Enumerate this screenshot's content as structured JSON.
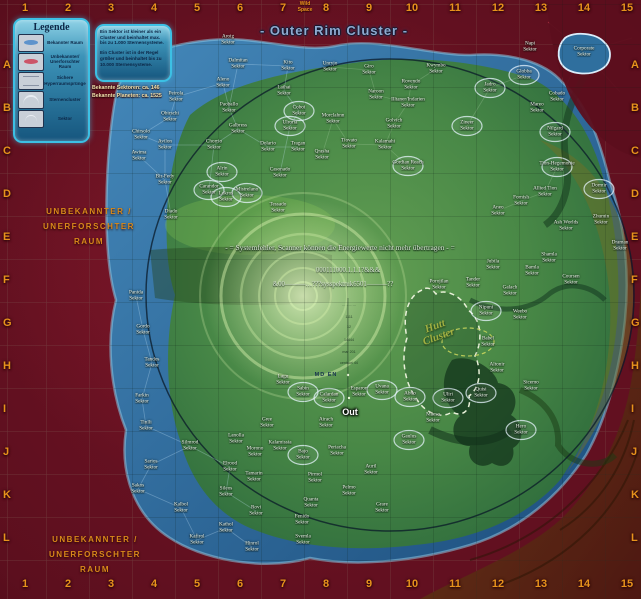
{
  "title": "- Outer Rim Cluster -",
  "wild": {
    "line1": "Wild",
    "line2": "Space"
  },
  "legend": {
    "title": "Legende",
    "items": [
      {
        "label": "Bekannter Raum",
        "icon": "blob-blue"
      },
      {
        "label": "Unbekannter/ Unerforschter Raum",
        "icon": "blob-red"
      },
      {
        "label": "Sichere Hyperraumsprünge",
        "icon": "lines"
      },
      {
        "label": "Sternencluster",
        "icon": "arc"
      },
      {
        "label": "Sektor",
        "icon": "arc2"
      }
    ]
  },
  "info_box": {
    "p1": "Ein Sektor ist kleiner als ein Cluster und beinhaltet max. bis zu 1.000 Sternensysteme.",
    "p2": "Ein Cluster ist in der Regel größer und beinhaltet bis zu 10.000 Sternensysteme."
  },
  "stats": {
    "sectors": "Bekannte Sektoren: ca. 146",
    "planets": "Bekannte Planeten: ca. 1525"
  },
  "unknown_label": {
    "line1": "UNBEKANNTER / UNERFORSCHTER",
    "line2": "RAUM"
  },
  "grid": {
    "columns": [
      "1",
      "2",
      "3",
      "4",
      "5",
      "6",
      "7",
      "8",
      "9",
      "10",
      "11",
      "12",
      "13",
      "14",
      "15"
    ],
    "rows": [
      "A",
      "B",
      "C",
      "D",
      "E",
      "F",
      "G",
      "H",
      "I",
      "J",
      "K",
      "L"
    ]
  },
  "scanner": {
    "error_line": "- = Systemfehler, Scanner können die Energiewerte nicht mehr übertragen - =",
    "code_line1": "000111000.1.1.1?&&&",
    "code_line2": "&00———…???sysspektruk6501———??",
    "md_en": "MD EN",
    "out": "Out",
    "ticks": [
      "…………",
      "1111",
      "12",
      "14444",
      "mar 201",
      "centauri 44"
    ]
  },
  "hutt_cluster": {
    "line1": "Hutt",
    "line2": "Cluster"
  },
  "sector_suffix": "Sektor",
  "sectors": [
    {
      "n": "Aroig",
      "x": 228,
      "y": 40,
      "o": 0
    },
    {
      "n": "Dalmitan",
      "x": 238,
      "y": 64,
      "o": 0
    },
    {
      "n": "Kito",
      "x": 288,
      "y": 66,
      "o": 0
    },
    {
      "n": "Aleno",
      "x": 223,
      "y": 83,
      "o": 0
    },
    {
      "n": "Laihai",
      "x": 284,
      "y": 91,
      "o": 0
    },
    {
      "n": "Peirola",
      "x": 176,
      "y": 97,
      "o": 0
    },
    {
      "n": "Paoballo",
      "x": 229,
      "y": 108,
      "o": 0
    },
    {
      "n": "Obirschi",
      "x": 170,
      "y": 117,
      "o": 0
    },
    {
      "n": "Coboi",
      "x": 299,
      "y": 111,
      "o": 1
    },
    {
      "n": "Ulroria",
      "x": 290,
      "y": 126,
      "o": 1
    },
    {
      "n": "Galbress",
      "x": 238,
      "y": 129,
      "o": 0
    },
    {
      "n": "Chirsolo",
      "x": 141,
      "y": 135,
      "o": 0
    },
    {
      "n": "Avilon",
      "x": 165,
      "y": 145,
      "o": 0
    },
    {
      "n": "Chorrio",
      "x": 214,
      "y": 145,
      "o": 0
    },
    {
      "n": "Dolario",
      "x": 268,
      "y": 147,
      "o": 0
    },
    {
      "n": "Tragan",
      "x": 298,
      "y": 147,
      "o": 0
    },
    {
      "n": "Awima",
      "x": 139,
      "y": 156,
      "o": 0
    },
    {
      "n": "Bir-Fedy",
      "x": 165,
      "y": 180,
      "o": 0
    },
    {
      "n": "Alrin",
      "x": 222,
      "y": 172,
      "o": 1
    },
    {
      "n": "Carandor",
      "x": 209,
      "y": 190,
      "o": 1
    },
    {
      "n": "Lekros",
      "x": 226,
      "y": 197,
      "o": 1
    },
    {
      "n": "Mistrelano",
      "x": 247,
      "y": 193,
      "o": 1
    },
    {
      "n": "Casonado",
      "x": 280,
      "y": 173,
      "o": 0
    },
    {
      "n": "Tessado",
      "x": 278,
      "y": 208,
      "o": 0
    },
    {
      "n": "Diado",
      "x": 171,
      "y": 215,
      "o": 0
    },
    {
      "n": "Panida",
      "x": 136,
      "y": 296,
      "o": 0
    },
    {
      "n": "Gordo",
      "x": 143,
      "y": 330,
      "o": 0
    },
    {
      "n": "Tandos",
      "x": 152,
      "y": 363,
      "o": 0
    },
    {
      "n": "Farkin",
      "x": 142,
      "y": 399,
      "o": 0
    },
    {
      "n": "Tinlli",
      "x": 146,
      "y": 426,
      "o": 0
    },
    {
      "n": "Sarios",
      "x": 151,
      "y": 465,
      "o": 0
    },
    {
      "n": "Sakos",
      "x": 138,
      "y": 489,
      "o": 0
    },
    {
      "n": "Kalbol",
      "x": 181,
      "y": 508,
      "o": 0
    },
    {
      "n": "Kafirol",
      "x": 197,
      "y": 540,
      "o": 0
    },
    {
      "n": "Hinrol",
      "x": 252,
      "y": 547,
      "o": 0
    },
    {
      "n": "Unryjo",
      "x": 330,
      "y": 67,
      "o": 0
    },
    {
      "n": "Giro",
      "x": 369,
      "y": 70,
      "o": 0
    },
    {
      "n": "Kwymbo",
      "x": 436,
      "y": 69,
      "o": 0
    },
    {
      "n": "Rovendo",
      "x": 411,
      "y": 85,
      "o": 0
    },
    {
      "n": "Naroon",
      "x": 376,
      "y": 95,
      "o": 0
    },
    {
      "n": "Illtaner/Indarien",
      "x": 408,
      "y": 103,
      "o": 0
    },
    {
      "n": "Morclahnn",
      "x": 333,
      "y": 119,
      "o": 0
    },
    {
      "n": "Golvich",
      "x": 394,
      "y": 124,
      "o": 0
    },
    {
      "n": "Zineer",
      "x": 467,
      "y": 126,
      "o": 1
    },
    {
      "n": "Tiovato",
      "x": 349,
      "y": 144,
      "o": 0
    },
    {
      "n": "Kalamahi",
      "x": 385,
      "y": 145,
      "o": 0
    },
    {
      "n": "Qrasha",
      "x": 322,
      "y": 155,
      "o": 0
    },
    {
      "n": "Gordian Reach",
      "x": 408,
      "y": 166,
      "o": 1
    },
    {
      "n": "Napi",
      "x": 530,
      "y": 47,
      "o": 0
    },
    {
      "n": "Globba",
      "x": 524,
      "y": 75,
      "o": 1
    },
    {
      "n": "Jadro",
      "x": 490,
      "y": 88,
      "o": 1
    },
    {
      "n": "Cobado",
      "x": 557,
      "y": 97,
      "o": 0
    },
    {
      "n": "Mareo",
      "x": 537,
      "y": 108,
      "o": 0
    },
    {
      "n": "Nilgard",
      "x": 555,
      "y": 132,
      "o": 1
    },
    {
      "n": "Tion-Hegemonie",
      "x": 557,
      "y": 167,
      "o": 1
    },
    {
      "n": "Allied Tion",
      "x": 545,
      "y": 192,
      "o": 0
    },
    {
      "n": "Dormir",
      "x": 599,
      "y": 189,
      "o": 1
    },
    {
      "n": "Fornish",
      "x": 521,
      "y": 201,
      "o": 0
    },
    {
      "n": "Aneo",
      "x": 498,
      "y": 211,
      "o": 0
    },
    {
      "n": "Zhumin",
      "x": 601,
      "y": 220,
      "o": 0
    },
    {
      "n": "Ash Worlds",
      "x": 566,
      "y": 226,
      "o": 0
    },
    {
      "n": "Draman",
      "x": 620,
      "y": 246,
      "o": 0
    },
    {
      "n": "Shamla",
      "x": 549,
      "y": 258,
      "o": 0
    },
    {
      "n": "Jubila",
      "x": 493,
      "y": 265,
      "o": 0
    },
    {
      "n": "Bamla",
      "x": 532,
      "y": 271,
      "o": 0
    },
    {
      "n": "Coursen",
      "x": 571,
      "y": 280,
      "o": 0
    },
    {
      "n": "Porojilan",
      "x": 439,
      "y": 285,
      "o": 0
    },
    {
      "n": "Tander",
      "x": 473,
      "y": 283,
      "o": 0
    },
    {
      "n": "Galach",
      "x": 510,
      "y": 291,
      "o": 0
    },
    {
      "n": "Nipuni",
      "x": 486,
      "y": 311,
      "o": 1
    },
    {
      "n": "Weebo",
      "x": 520,
      "y": 315,
      "o": 0
    },
    {
      "n": "Babel",
      "x": 488,
      "y": 342,
      "o": 0
    },
    {
      "n": "Altonir",
      "x": 497,
      "y": 368,
      "o": 0
    },
    {
      "n": "Lagu",
      "x": 283,
      "y": 380,
      "o": 0
    },
    {
      "n": "Sabin",
      "x": 303,
      "y": 392,
      "o": 1
    },
    {
      "n": "Calardan",
      "x": 329,
      "y": 398,
      "o": 1
    },
    {
      "n": "Esparon",
      "x": 359,
      "y": 392,
      "o": 0
    },
    {
      "n": "Uvana",
      "x": 382,
      "y": 390,
      "o": 1
    },
    {
      "n": "Abilo",
      "x": 410,
      "y": 397,
      "o": 1
    },
    {
      "n": "Uliri",
      "x": 448,
      "y": 398,
      "o": 1
    },
    {
      "n": "Quisi",
      "x": 481,
      "y": 393,
      "o": 1
    },
    {
      "n": "Sicemo",
      "x": 531,
      "y": 386,
      "o": 0
    },
    {
      "n": "Maeso",
      "x": 433,
      "y": 418,
      "o": 0
    },
    {
      "n": "Gaulus",
      "x": 409,
      "y": 440,
      "o": 1
    },
    {
      "n": "Hero",
      "x": 521,
      "y": 430,
      "o": 1
    },
    {
      "n": "Airach",
      "x": 326,
      "y": 423,
      "o": 0
    },
    {
      "n": "Gree",
      "x": 267,
      "y": 423,
      "o": 0
    },
    {
      "n": "Lanolla",
      "x": 236,
      "y": 439,
      "o": 0
    },
    {
      "n": "Silmrod",
      "x": 190,
      "y": 446,
      "o": 0
    },
    {
      "n": "Kalamissia",
      "x": 280,
      "y": 446,
      "o": 0
    },
    {
      "n": "Periacha",
      "x": 337,
      "y": 451,
      "o": 0
    },
    {
      "n": "Morono",
      "x": 255,
      "y": 452,
      "o": 0
    },
    {
      "n": "Bajo",
      "x": 303,
      "y": 455,
      "o": 1
    },
    {
      "n": "Elrood",
      "x": 230,
      "y": 467,
      "o": 0
    },
    {
      "n": "Auril",
      "x": 371,
      "y": 470,
      "o": 0
    },
    {
      "n": "Tamarin",
      "x": 254,
      "y": 477,
      "o": 0
    },
    {
      "n": "Pirmol",
      "x": 315,
      "y": 478,
      "o": 0
    },
    {
      "n": "Pelmo",
      "x": 349,
      "y": 491,
      "o": 0
    },
    {
      "n": "Sileos",
      "x": 226,
      "y": 492,
      "o": 0
    },
    {
      "n": "Quanta",
      "x": 311,
      "y": 503,
      "o": 0
    },
    {
      "n": "Grare",
      "x": 382,
      "y": 508,
      "o": 0
    },
    {
      "n": "Rovi",
      "x": 256,
      "y": 511,
      "o": 0
    },
    {
      "n": "Fenido",
      "x": 302,
      "y": 520,
      "o": 0
    },
    {
      "n": "Kathol",
      "x": 226,
      "y": 528,
      "o": 0
    },
    {
      "n": "Svemla",
      "x": 303,
      "y": 540,
      "o": 0
    },
    {
      "n": "Corporate",
      "x": 584,
      "y": 52,
      "o": 0
    }
  ]
}
